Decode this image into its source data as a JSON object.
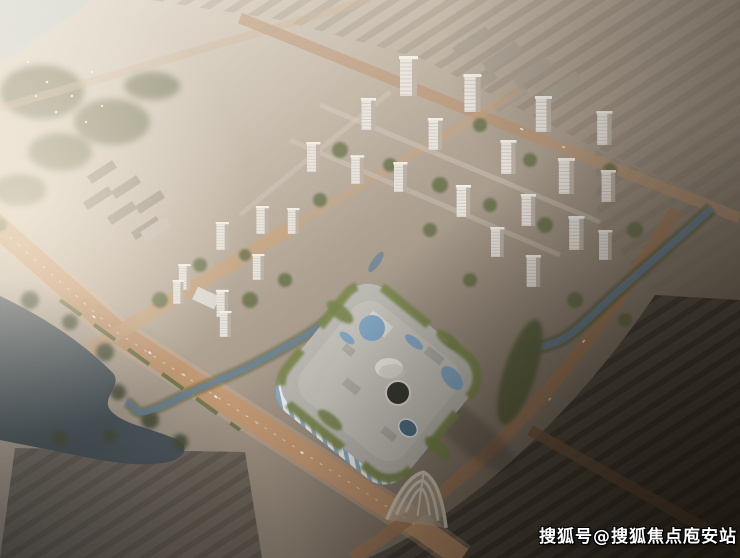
{
  "scene": {
    "description": "Aerial architectural rendering of a residential development: grid of white high-rise towers, a blue-and-white striped shopping mall with rooftop pools, roads, canal and lake, hazy sunlit city in background"
  },
  "watermark": {
    "text": "搜狐号@搜狐焦点庖安站",
    "color": "#ffffff"
  },
  "colors": {
    "water_top": "#c2cbcd",
    "lake": "#3a4750",
    "canal": "#5b7890",
    "pool_blue": "#76a0c2",
    "road_tan": "#bf8f66",
    "road_dark": "#9b7250",
    "tree_green": "#4c5531",
    "tower_face": "#e7e4de",
    "tower_shade": "#b2a99d",
    "tower_roof": "#f1efe9",
    "mall_roof": "#b6b4af",
    "mall_plaza": "#c1bfb9",
    "mall_green_edge": "#6f7d42",
    "dome_white": "#e9e7e2",
    "atrium_dark": "#22251f",
    "glass_blue": "#3e617e"
  }
}
